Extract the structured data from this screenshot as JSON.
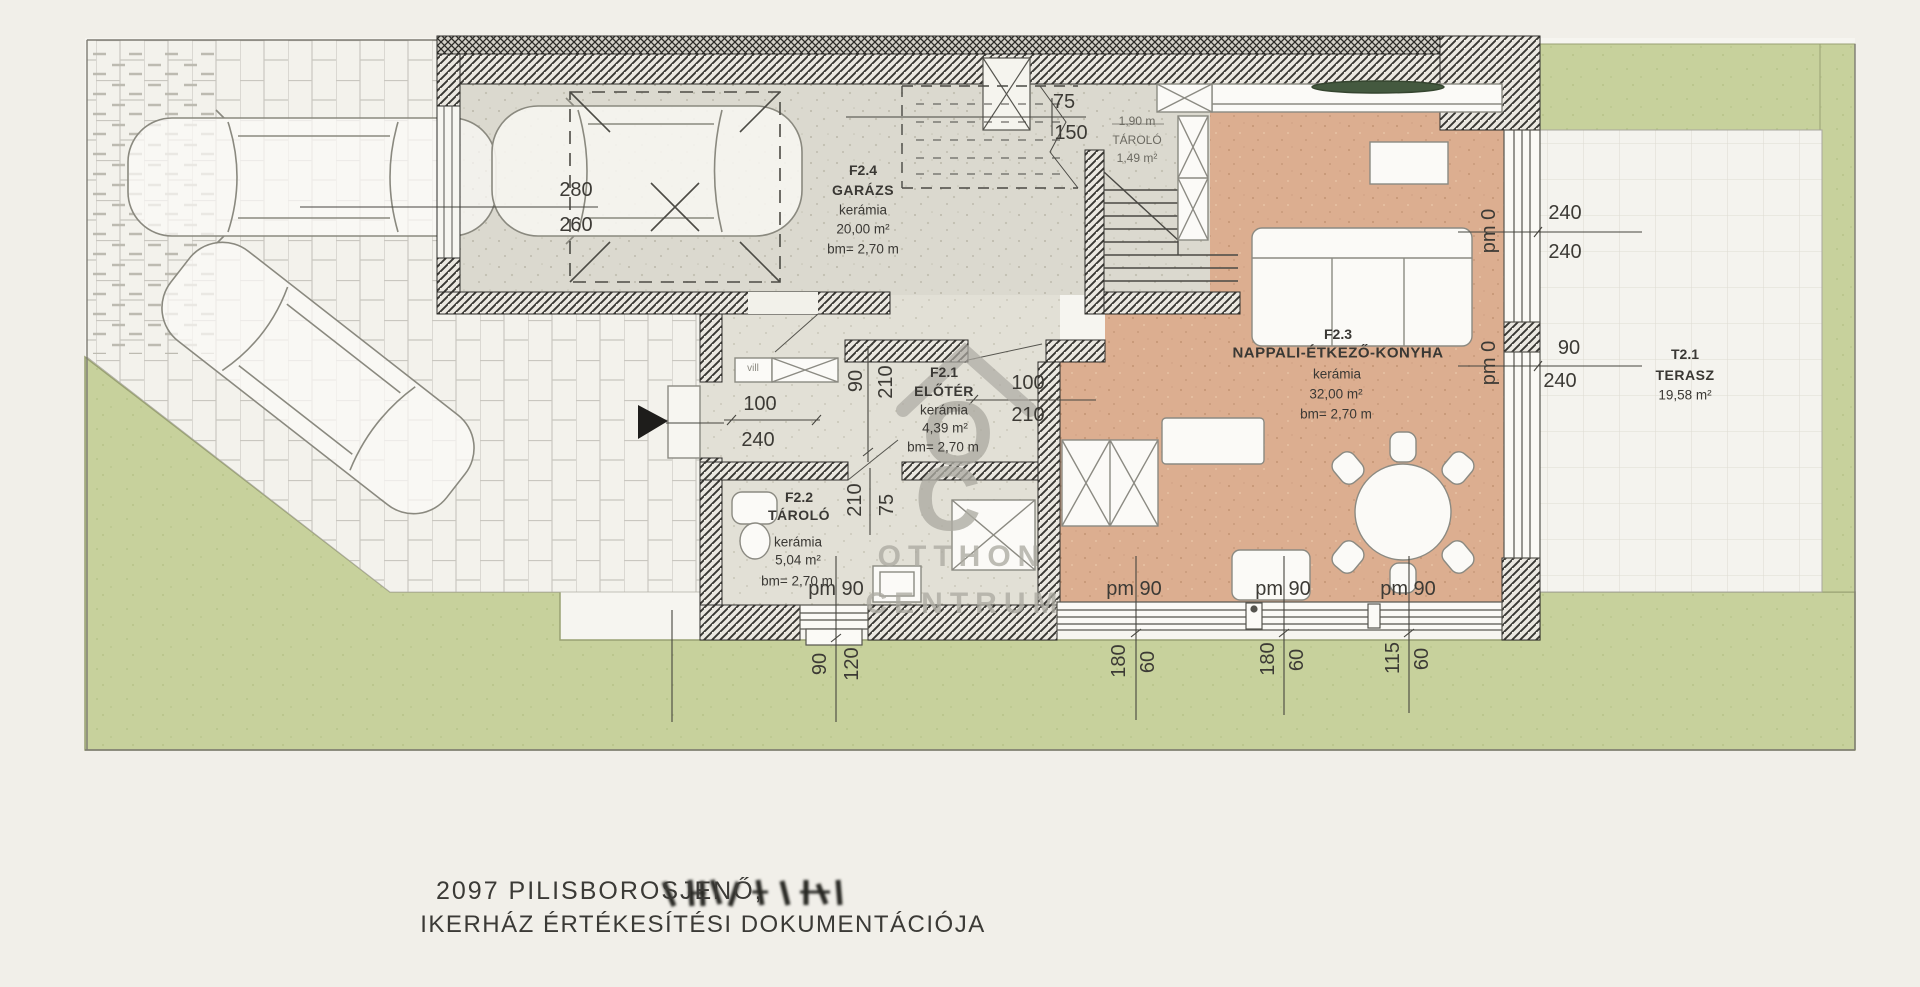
{
  "document": {
    "address_line": "2097 PILISBOROSJENŐ,",
    "subtitle_line": "IKERHÁZ ÉRTÉKESÍTÉSI DOKUMENTÁCIÓJA"
  },
  "watermark": {
    "letter_o": "O",
    "letter_c": "C",
    "line1": "OTTHON",
    "line2": "CENTRUM"
  },
  "rooms": {
    "garage": {
      "code": "F2.4",
      "name": "GARÁZS",
      "finish": "kerámia",
      "area": "20,00 m²",
      "height": "bm= 2,70 m"
    },
    "eloter": {
      "code": "F2.1",
      "name": "ELŐTÉR",
      "finish": "kerámia",
      "area": "4,39 m²",
      "height": "bm= 2,70 m"
    },
    "tarolo": {
      "code": "F2.2",
      "name": "TÁROLÓ",
      "finish": "kerámia",
      "area": "5,04 m²",
      "height": "bm= 2,70 m"
    },
    "nappali": {
      "code": "F2.3",
      "name": "NAPPALI-ÉTKEZŐ-KONYHA",
      "finish": "kerámia",
      "area": "32,00 m²",
      "height": "bm= 2,70 m"
    },
    "terasz": {
      "code": "T2.1",
      "name": "TERASZ",
      "area": "19,58 m²"
    },
    "understair": {
      "width": "1,90 m",
      "name": "TÁROLÓ",
      "area": "1,49 m²"
    }
  },
  "dimensions": {
    "garage_spot_width": "280",
    "garage_spot_depth": "260",
    "stair_width": "75",
    "stair_run": "150",
    "entry_door": {
      "w": "100",
      "h": "240"
    },
    "living_door": {
      "w": "100",
      "h": "210"
    },
    "eloter_side": {
      "a": "90",
      "b": "210"
    },
    "tarolo_side": {
      "a": "210",
      "b": "75"
    },
    "right_window_top": {
      "a": "240",
      "b": "240"
    },
    "right_window_bottom": {
      "a": "90",
      "b": "240"
    },
    "pm0": "pm 0",
    "pm90": "pm 90",
    "bottom1": {
      "a": "90",
      "b": "120"
    },
    "bottom2": {
      "a": "180",
      "b": "60"
    },
    "bottom3": {
      "a": "180",
      "b": "60"
    },
    "bottom4": {
      "a": "115",
      "b": "60"
    },
    "vill_label": "vill"
  }
}
